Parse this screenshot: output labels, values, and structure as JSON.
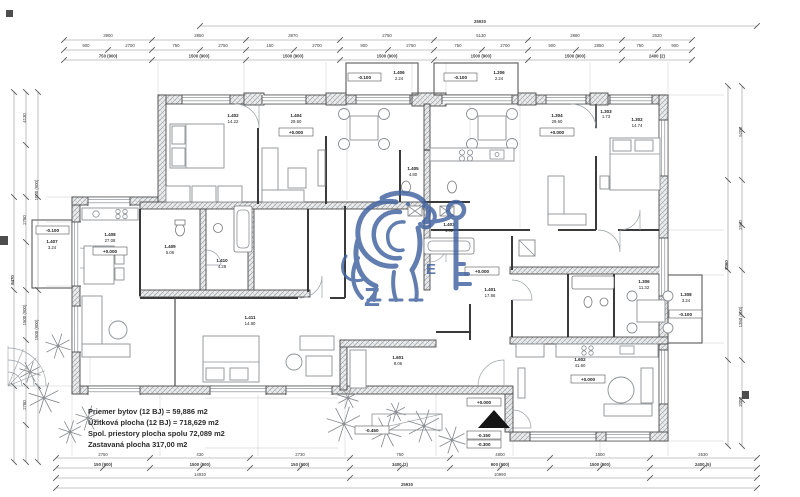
{
  "drawing": {
    "summary": {
      "line1": "Priemer bytov (12 BJ) = 59,886 m2",
      "line2": "Úžitková plocha (12 BJ) = 718,629 m2",
      "line3": "Spol. priestory plocha spolu 72,089 m2",
      "line4": "Zastavaná plocha 317,00 m2"
    }
  },
  "levels": {
    "zero": "+0.000",
    "m100": "-0.100",
    "m150": "-0.150",
    "m300": "-0.300",
    "m450": "-0.450"
  },
  "rooms": [
    {
      "number": "1.402",
      "area": "14.22"
    },
    {
      "number": "1.404",
      "area": "29.60"
    },
    {
      "number": "1.406",
      "area": "2.24"
    },
    {
      "number": "1.206",
      "area": "2.24"
    },
    {
      "number": "1.304",
      "area": "29.60"
    },
    {
      "number": "1.302",
      "area": "14.74"
    },
    {
      "number": "1.303",
      "area": "1.73"
    },
    {
      "number": "1.407",
      "area": "3.24"
    },
    {
      "number": "1.408",
      "area": "27.08"
    },
    {
      "number": "1.409",
      "area": "5.06"
    },
    {
      "number": "1.410",
      "area": "4.28"
    },
    {
      "number": "1.401",
      "area": "17.86"
    },
    {
      "number": "1.403",
      "area": "4.92"
    },
    {
      "number": "1.411",
      "area": "14.80"
    },
    {
      "number": "1.601",
      "area": "8.06"
    },
    {
      "number": "1.602",
      "area": "41.60"
    },
    {
      "number": "1.306",
      "area": "11.32"
    },
    {
      "number": "1.308",
      "area": "3.24"
    },
    {
      "number": "1.405",
      "area": "4.80"
    }
  ],
  "dims": {
    "top_total": "25930",
    "top_row1": [
      "3900",
      "2850",
      "3970",
      "2750",
      "5130",
      "2880",
      "2620"
    ],
    "top_row2": [
      "900",
      "2700",
      "750",
      "2750",
      "150",
      "2700",
      "900",
      "2750",
      "750",
      "2700",
      "900",
      "2850",
      "750",
      "900"
    ],
    "top_row3": [
      "750 (900)",
      "1500 (900)",
      "1500 (900)",
      "1500 (900)",
      "1500 (900)",
      "1500 (900)",
      "2400 (2)"
    ],
    "bottom_row1": [
      "2750",
      "430",
      "2730",
      "750",
      "4800",
      "1500",
      "2530"
    ],
    "bottom_row2": [
      "150 (900)",
      "1500 (900)",
      "150 (900)",
      "3400 (2)",
      "900 (900)",
      "1500 (900)",
      "2400 (5)"
    ],
    "bottom_row3": [
      "14930",
      "10990"
    ],
    "bottom_total": "25930",
    "left_col1": [
      "4130",
      "2780",
      "1500 (900)",
      "2780"
    ],
    "left_col2": [
      "1000 (900)",
      "1500 (900)"
    ],
    "left_total": "8470",
    "right_col1": [
      "5200",
      "2560",
      "1350 (900)",
      "2000"
    ],
    "right_total": "8360"
  },
  "watermark": {
    "color": "#40619f",
    "letter_left": "Z",
    "letter_right": "E"
  }
}
